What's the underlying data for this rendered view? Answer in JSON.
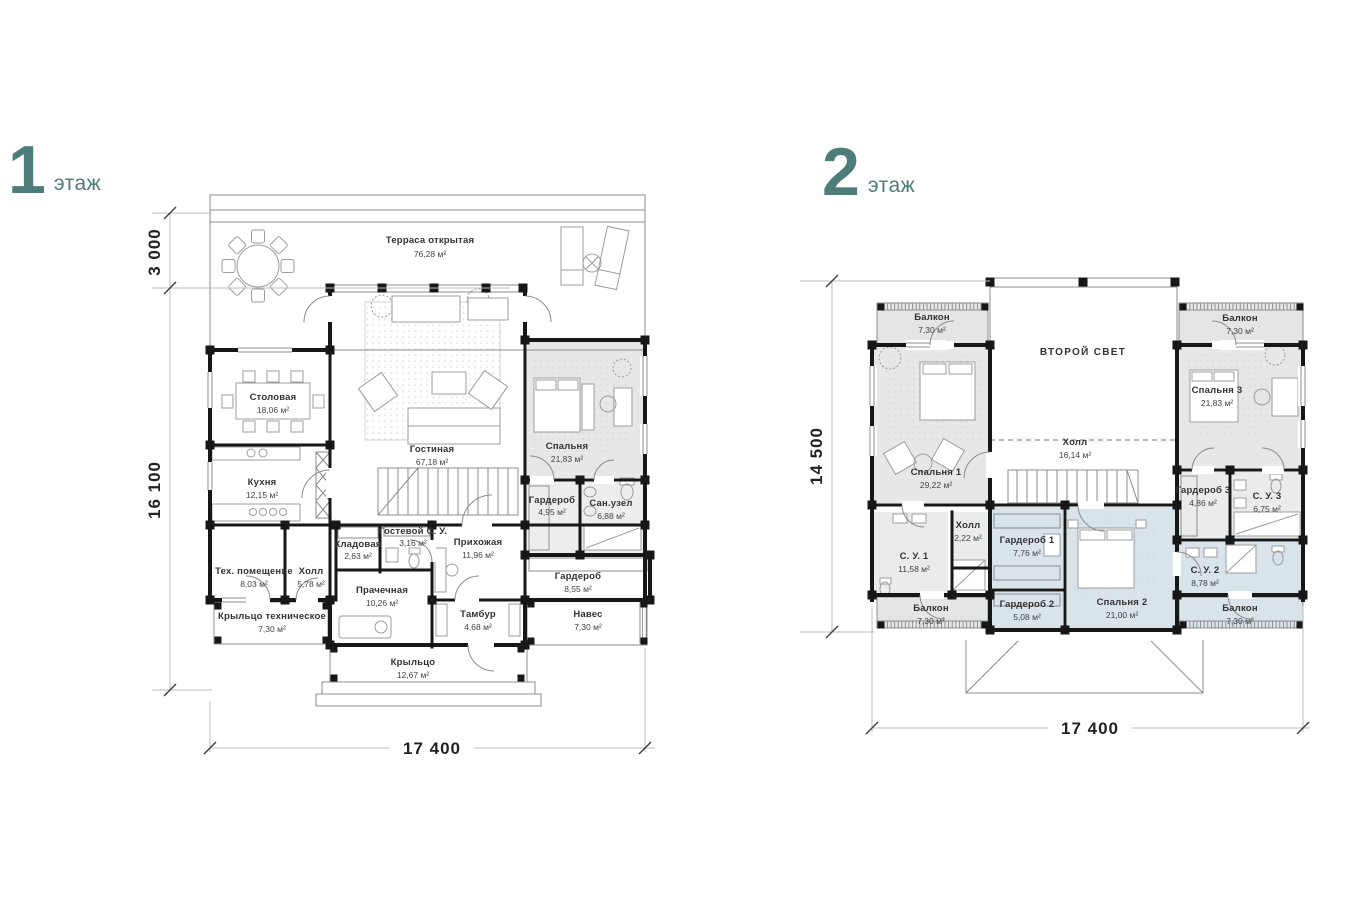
{
  "colors": {
    "accent_teal": "#4e7c78",
    "wall_black": "#171717",
    "room_gray": "#e6e8e7",
    "room_gray_light": "#eaecec",
    "room_blue": "#d9e3ea",
    "background": "#ffffff"
  },
  "floor1": {
    "number": "1",
    "word": "этаж",
    "dims": {
      "top": "3 000",
      "left": "16 100",
      "bottom": "17 400"
    },
    "rooms": [
      {
        "name": "Терраса открытая",
        "area": "76,28 м²"
      },
      {
        "name": "Столовая",
        "area": "18,06 м²"
      },
      {
        "name": "Гостиная",
        "area": "67,18 м²"
      },
      {
        "name": "Спальня",
        "area": "21,83 м²"
      },
      {
        "name": "Кухня",
        "area": "12,15 м²"
      },
      {
        "name": "Гардероб",
        "area": "4,95 м²"
      },
      {
        "name": "Сан.узел",
        "area": "6,88 м²"
      },
      {
        "name": "Тех. помещение",
        "area": "8,03 м²"
      },
      {
        "name": "Холл",
        "area": "5,78 м²"
      },
      {
        "name": "Кладовая",
        "area": "2,63 м²"
      },
      {
        "name": "Гостевой С. У.",
        "area": "3,16 м²"
      },
      {
        "name": "Прихожая",
        "area": "11,96 м²"
      },
      {
        "name": "Прачечная",
        "area": "10,26 м²"
      },
      {
        "name": "Гардероб",
        "area": "8,55 м²"
      },
      {
        "name": "Крыльцо техническое",
        "area": "7,30 м²"
      },
      {
        "name": "Тамбур",
        "area": "4,68 м²"
      },
      {
        "name": "Навес",
        "area": "7,30 м²"
      },
      {
        "name": "Крыльцо",
        "area": "12,67 м²"
      }
    ]
  },
  "floor2": {
    "number": "2",
    "word": "этаж",
    "dims": {
      "left": "14 500",
      "bottom": "17 400"
    },
    "rooms": [
      {
        "name": "Балкон",
        "area": "7,30 м²"
      },
      {
        "name": "ВТОРОЙ СВЕТ",
        "area": ""
      },
      {
        "name": "Балкон",
        "area": "7,30 м²"
      },
      {
        "name": "Спальня 1",
        "area": "29,22 м²"
      },
      {
        "name": "Спальня 3",
        "area": "21,83 м²"
      },
      {
        "name": "Холл",
        "area": "16,14 м²"
      },
      {
        "name": "Гардероб 3",
        "area": "4,86 м²"
      },
      {
        "name": "С. У. 3",
        "area": "6,75 м²"
      },
      {
        "name": "С. У. 1",
        "area": "11,58 м²"
      },
      {
        "name": "Холл",
        "area": "2,22 м²"
      },
      {
        "name": "Гардероб 1",
        "area": "7,76 м²"
      },
      {
        "name": "С. У. 2",
        "area": "8,78 м²"
      },
      {
        "name": "Балкон",
        "area": "7,30 м²"
      },
      {
        "name": "Гардероб 2",
        "area": "5,08 м²"
      },
      {
        "name": "Спальня 2",
        "area": "21,00 м²"
      },
      {
        "name": "Балкон",
        "area": "7,30 м²"
      }
    ]
  }
}
